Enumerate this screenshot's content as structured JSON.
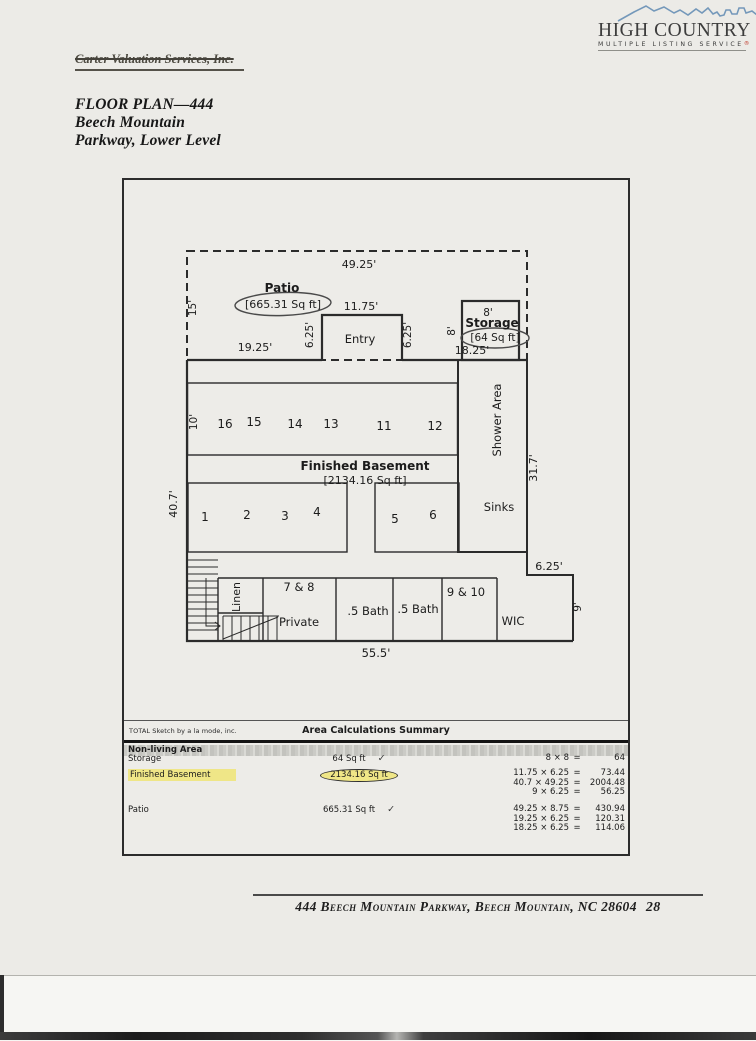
{
  "logo": {
    "name": "HIGH COUNTRY",
    "tagline": "MULTIPLE LISTING SERVICE",
    "reg": "®"
  },
  "letterhead": {
    "company": "Carter Valuation Services, Inc."
  },
  "title": {
    "line1": "FLOOR PLAN—444",
    "line2": "Beech Mountain",
    "line3": "Parkway, Lower Level"
  },
  "plan": {
    "dim_top": "49.25'",
    "patio": "Patio",
    "patio_sqft": "[665.31 Sq ft]",
    "dim_left_top": "15'",
    "dim_19_25": "19.25'",
    "dim_6_25_left": "6.25'",
    "dim_11_75": "11.75'",
    "entry": "Entry",
    "dim_6_25_right": "6.25'",
    "dim_8_left": "8'",
    "dim_8_top": "8'",
    "storage": "Storage",
    "storage_sqft": "[64 Sq ft]",
    "dim_18_25": "18.25'",
    "dim_10": "10'",
    "rooms_top": [
      "16",
      "15",
      "14",
      "13",
      "11",
      "12"
    ],
    "shower": "Shower Area",
    "dim_31_7": "31.7'",
    "finished_basement": "Finished Basement",
    "finished_basement_sqft": "[2134.16 Sq ft]",
    "dim_40_7": "40.7'",
    "rooms_mid": [
      "1",
      "2",
      "3",
      "4",
      "5",
      "6"
    ],
    "sinks": "Sinks",
    "dim_6_25_br": "6.25'",
    "dim_9": "9'",
    "linen": "Linen",
    "room_78": "7 & 8",
    "private": "Private",
    "bath1": ".5 Bath",
    "bath2": ".5 Bath",
    "room_910": "9 & 10",
    "wic": "WIC",
    "dim_55_5": "55.5'"
  },
  "table": {
    "brand": "TOTAL Sketch by a la mode, inc.",
    "title": "Area Calculations Summary",
    "section": "Non-living Area",
    "eq": "=",
    "rows": [
      {
        "label": "Storage",
        "value": "64 Sq ft",
        "check": "✓",
        "calcs": [
          {
            "expr": "8 × 8",
            "res": "64"
          }
        ]
      },
      {
        "label": "Finished Basement",
        "value": "2134.16 Sq ft",
        "calcs": [
          {
            "expr": "11.75 × 6.25",
            "res": "73.44"
          },
          {
            "expr": "40.7 × 49.25",
            "res": "2004.48"
          },
          {
            "expr": "9 × 6.25",
            "res": "56.25"
          }
        ]
      },
      {
        "label": "Patio",
        "value": "665.31 Sq ft",
        "check": "✓",
        "calcs": [
          {
            "expr": "49.25 × 8.75",
            "res": "430.94"
          },
          {
            "expr": "19.25 × 6.25",
            "res": "120.31"
          },
          {
            "expr": "18.25 × 6.25",
            "res": "114.06"
          }
        ]
      }
    ]
  },
  "footer": {
    "address": "444 Beech Mountain Parkway, Beech Mountain, NC 28604",
    "page": "28"
  }
}
